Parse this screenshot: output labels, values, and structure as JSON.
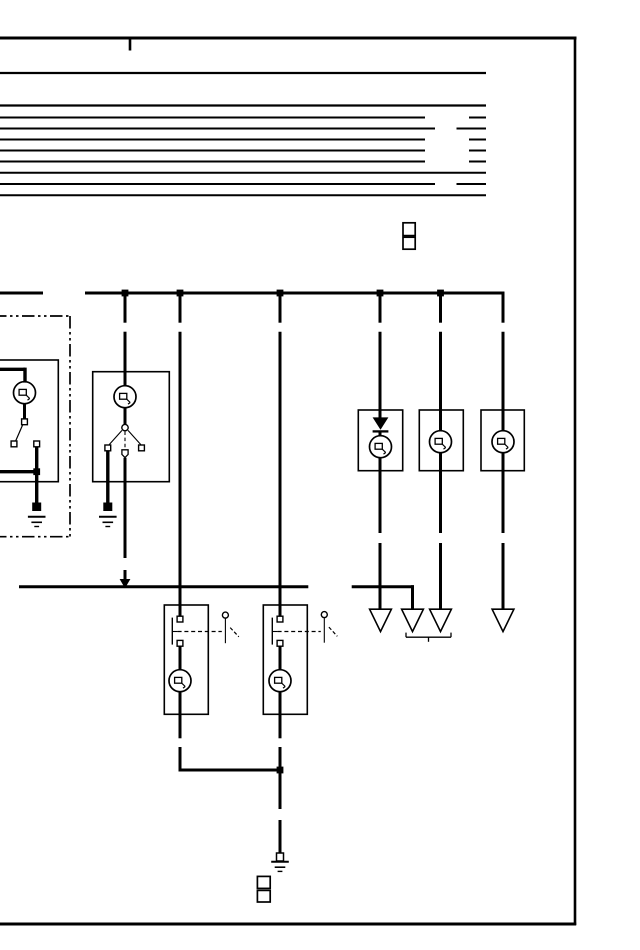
{
  "meta": {
    "width": 640,
    "height": 950,
    "bg": "#ffffff",
    "ink": "#000000",
    "kind": "automotive-wiring-diagram-scan",
    "symbols": {
      "bulb": "lamp-symbol",
      "gnd": "ground-symbol",
      "dot": "wire-junction",
      "poly": "filled-shape",
      "term": "connector-terminal",
      "pent": "connector-terminal-pointed",
      "tofu": "unrendered-text-glyph-box"
    }
  },
  "elements": [
    {
      "t": "line",
      "n": "frame-top-border",
      "x1": 0,
      "y1": 38,
      "x2": 576.5,
      "y2": 38,
      "w": 3
    },
    {
      "t": "line",
      "n": "frame-right-border",
      "x1": 575,
      "y1": 37,
      "x2": 575,
      "y2": 925,
      "w": 2.6
    },
    {
      "t": "line",
      "n": "frame-bottom-border",
      "x1": 0,
      "y1": 924,
      "x2": 576.2,
      "y2": 924,
      "w": 3
    },
    {
      "t": "line",
      "n": "frame-top-tick",
      "x1": 130,
      "y1": 39,
      "x2": 130,
      "y2": 50.5,
      "w": 2.6
    },
    {
      "t": "line",
      "n": "header-rule",
      "x1": 0,
      "y1": 73,
      "x2": 486,
      "y2": 73,
      "w": 2.3
    },
    {
      "t": "line",
      "n": "header-rule",
      "x1": 0,
      "y1": 105.5,
      "x2": 486,
      "y2": 105.5,
      "w": 2.3
    },
    {
      "t": "line",
      "n": "header-rule",
      "x1": 0,
      "y1": 117.5,
      "x2": 425,
      "y2": 117.5,
      "w": 2
    },
    {
      "t": "line",
      "n": "header-rule-stub",
      "x1": 469,
      "y1": 117.5,
      "x2": 486,
      "y2": 117.5,
      "w": 2
    },
    {
      "t": "line",
      "n": "header-rule",
      "x1": 0,
      "y1": 128.5,
      "x2": 435,
      "y2": 128.5,
      "w": 2
    },
    {
      "t": "line",
      "n": "header-rule-stub",
      "x1": 456.5,
      "y1": 128.5,
      "x2": 486,
      "y2": 128.5,
      "w": 2
    },
    {
      "t": "line",
      "n": "header-rule",
      "x1": 0,
      "y1": 139.5,
      "x2": 425,
      "y2": 139.5,
      "w": 2
    },
    {
      "t": "line",
      "n": "header-rule-stub",
      "x1": 469,
      "y1": 139.5,
      "x2": 486,
      "y2": 139.5,
      "w": 2
    },
    {
      "t": "line",
      "n": "header-rule",
      "x1": 0,
      "y1": 150.5,
      "x2": 425,
      "y2": 150.5,
      "w": 2
    },
    {
      "t": "line",
      "n": "header-rule-stub",
      "x1": 469,
      "y1": 150.5,
      "x2": 486,
      "y2": 150.5,
      "w": 2
    },
    {
      "t": "line",
      "n": "header-rule",
      "x1": 0,
      "y1": 161.5,
      "x2": 425,
      "y2": 161.5,
      "w": 2
    },
    {
      "t": "line",
      "n": "header-rule-stub",
      "x1": 469,
      "y1": 161.5,
      "x2": 486,
      "y2": 161.5,
      "w": 2
    },
    {
      "t": "line",
      "n": "header-rule",
      "x1": 0,
      "y1": 172.8,
      "x2": 486,
      "y2": 172.8,
      "w": 2
    },
    {
      "t": "line",
      "n": "header-rule",
      "x1": 0,
      "y1": 184,
      "x2": 435,
      "y2": 184,
      "w": 2
    },
    {
      "t": "line",
      "n": "header-rule-stub",
      "x1": 456.5,
      "y1": 184,
      "x2": 486,
      "y2": 184,
      "w": 2
    },
    {
      "t": "line",
      "n": "header-rule",
      "x1": 0,
      "y1": 195.2,
      "x2": 486,
      "y2": 195.2,
      "w": 2
    },
    {
      "t": "tofu",
      "n": "unrendered-label-box",
      "x": 403,
      "y": 222.8,
      "w": 12.2,
      "h": 12.8
    },
    {
      "t": "tofu",
      "n": "unrendered-label-box",
      "x": 403,
      "y": 237.2,
      "w": 12.2,
      "h": 12
    },
    {
      "t": "line",
      "n": "harness-enclosure-dashdot",
      "x1": -6,
      "y1": 316,
      "x2": 70,
      "y2": 316,
      "w": 1.7,
      "dash": "12.5 3.5 2.5 3.5 2.5 3.5"
    },
    {
      "t": "line",
      "n": "harness-enclosure-dashdot",
      "x1": 70,
      "y1": 316,
      "x2": 70,
      "y2": 536.7,
      "w": 1.7,
      "dash": "12.5 3.5 2.5 3.5 2.5 3.5"
    },
    {
      "t": "line",
      "n": "harness-enclosure-dashdot",
      "x1": -6,
      "y1": 536.7,
      "x2": 70,
      "y2": 536.7,
      "w": 1.7,
      "dash": "12.5 3.5 2.5 3.5 2.5 3.5"
    },
    {
      "t": "rect",
      "n": "component-box-lamp-switch-1",
      "x": -12,
      "y": 360,
      "w": 70.3,
      "h": 121.7
    },
    {
      "t": "rect",
      "n": "component-box-lamp-switch-2",
      "x": 92.7,
      "y": 371.7,
      "w": 76.6,
      "h": 110
    },
    {
      "t": "rect",
      "n": "component-box-switch-lamp-A",
      "x": 164.3,
      "y": 605,
      "w": 44,
      "h": 109.3
    },
    {
      "t": "rect",
      "n": "component-box-switch-lamp-B",
      "x": 263.3,
      "y": 605,
      "w": 44,
      "h": 109.3
    },
    {
      "t": "rect",
      "n": "component-box-diode-lamp",
      "x": 358.3,
      "y": 410,
      "w": 44.4,
      "h": 60.7
    },
    {
      "t": "rect",
      "n": "component-box-lamp-R2",
      "x": 419.3,
      "y": 410,
      "w": 44,
      "h": 60.7
    },
    {
      "t": "rect",
      "n": "component-box-lamp-R3",
      "x": 481,
      "y": 410,
      "w": 43.3,
      "h": 60.7
    },
    {
      "t": "line",
      "n": "bus-wire",
      "x1": 0,
      "y1": 293,
      "x2": 43,
      "y2": 293,
      "w": 3
    },
    {
      "t": "line",
      "n": "bus-wire",
      "x1": 85,
      "y1": 293,
      "x2": 504.3,
      "y2": 293,
      "w": 3
    },
    {
      "t": "line",
      "n": "wire-drop",
      "x1": 503,
      "y1": 291.6,
      "x2": 503,
      "y2": 322.7,
      "w": 3
    },
    {
      "t": "line",
      "n": "wire-drop",
      "x1": 125,
      "y1": 293,
      "x2": 125,
      "y2": 322.7,
      "w": 3
    },
    {
      "t": "line",
      "n": "wire-drop",
      "x1": 125,
      "y1": 331.7,
      "x2": 125,
      "y2": 386.5,
      "w": 3
    },
    {
      "t": "line",
      "n": "wire-drop",
      "x1": 180,
      "y1": 293,
      "x2": 180,
      "y2": 322.7,
      "w": 3
    },
    {
      "t": "line",
      "n": "wire-drop",
      "x1": 180,
      "y1": 331.7,
      "x2": 180,
      "y2": 616.3,
      "w": 3
    },
    {
      "t": "line",
      "n": "wire-drop",
      "x1": 280,
      "y1": 293,
      "x2": 280,
      "y2": 322.7,
      "w": 3
    },
    {
      "t": "line",
      "n": "wire-drop",
      "x1": 280,
      "y1": 331.7,
      "x2": 280,
      "y2": 616.3,
      "w": 3
    },
    {
      "t": "line",
      "n": "wire-drop",
      "x1": 380,
      "y1": 293,
      "x2": 380,
      "y2": 322.7,
      "w": 3
    },
    {
      "t": "line",
      "n": "wire-drop",
      "x1": 380,
      "y1": 331.7,
      "x2": 380,
      "y2": 418.3,
      "w": 3
    },
    {
      "t": "line",
      "n": "wire-drop",
      "x1": 440.5,
      "y1": 293,
      "x2": 440.5,
      "y2": 322.7,
      "w": 3
    },
    {
      "t": "line",
      "n": "wire-drop",
      "x1": 440.5,
      "y1": 331.7,
      "x2": 440.5,
      "y2": 431.3,
      "w": 3
    },
    {
      "t": "line",
      "n": "wire-drop",
      "x1": 503,
      "y1": 331.7,
      "x2": 503,
      "y2": 431.3,
      "w": 3
    },
    {
      "t": "line",
      "n": "wire",
      "x1": 0,
      "y1": 369.3,
      "x2": 25,
      "y2": 369.3,
      "w": 3.4
    },
    {
      "t": "line",
      "n": "wire",
      "x1": 25,
      "y1": 367.6,
      "x2": 25,
      "y2": 382.6,
      "w": 3.4
    },
    {
      "t": "line",
      "n": "wire",
      "x1": 24.5,
      "y1": 403.2,
      "x2": 24.5,
      "y2": 419,
      "w": 3
    },
    {
      "t": "line",
      "n": "switch-lever",
      "x1": 22.6,
      "y1": 425,
      "x2": 15.8,
      "y2": 440.6,
      "w": 1.2
    },
    {
      "t": "line",
      "n": "wire",
      "x1": 36.7,
      "y1": 446.6,
      "x2": 36.7,
      "y2": 503.5,
      "w": 3.4
    },
    {
      "t": "line",
      "n": "wire",
      "x1": 0,
      "y1": 471.7,
      "x2": 36.7,
      "y2": 471.7,
      "w": 3.4
    },
    {
      "t": "line",
      "n": "wire",
      "x1": 125,
      "y1": 407.2,
      "x2": 125,
      "y2": 424.3,
      "w": 3
    },
    {
      "t": "line",
      "n": "switch-lever",
      "x1": 122,
      "y1": 430.4,
      "x2": 109.2,
      "y2": 444.6,
      "w": 1.1
    },
    {
      "t": "line",
      "n": "switch-lever",
      "x1": 128,
      "y1": 430.4,
      "x2": 140.8,
      "y2": 444.6,
      "w": 1.1
    },
    {
      "t": "line",
      "n": "switch-link-dashed",
      "x1": 125,
      "y1": 431.5,
      "x2": 125,
      "y2": 448.2,
      "w": 1.1,
      "dash": "3.5 2.6"
    },
    {
      "t": "line",
      "n": "wire",
      "x1": 107.8,
      "y1": 450.6,
      "x2": 107.8,
      "y2": 503.5,
      "w": 3.4
    },
    {
      "t": "line",
      "n": "wire",
      "x1": 125,
      "y1": 457.8,
      "x2": 125,
      "y2": 558,
      "w": 3
    },
    {
      "t": "line",
      "n": "wire",
      "x1": 125,
      "y1": 570,
      "x2": 125,
      "y2": 580.2,
      "w": 3
    },
    {
      "t": "line",
      "n": "feed-bus-wire",
      "x1": 19,
      "y1": 586.7,
      "x2": 308.3,
      "y2": 586.7,
      "w": 3
    },
    {
      "t": "line",
      "n": "feed-bus-wire",
      "x1": 351.7,
      "y1": 586.7,
      "x2": 414,
      "y2": 586.7,
      "w": 3
    },
    {
      "t": "line",
      "n": "wire-drop",
      "x1": 412.5,
      "y1": 585.2,
      "x2": 412.5,
      "y2": 609.8,
      "w": 3
    },
    {
      "t": "line",
      "n": "switch-plate",
      "x1": 172.3,
      "y1": 617.6,
      "x2": 172.3,
      "y2": 644.6,
      "w": 1.4
    },
    {
      "t": "line",
      "n": "switch-plate-tick",
      "x1": 172.9,
      "y1": 631.5,
      "x2": 177.6,
      "y2": 631.5,
      "w": 1.1
    },
    {
      "t": "line",
      "n": "switch-link-dashed",
      "x1": 177.6,
      "y1": 631.5,
      "x2": 221.8,
      "y2": 631.5,
      "w": 1.2,
      "dash": "4 2.8"
    },
    {
      "t": "line",
      "n": "switch-lever",
      "x1": 225.4,
      "y1": 618.4,
      "x2": 225.4,
      "y2": 643.2,
      "w": 1.1
    },
    {
      "t": "line",
      "n": "switch-lever-dashed",
      "x1": 230.2,
      "y1": 627.6,
      "x2": 238.8,
      "y2": 636.8,
      "w": 1.2,
      "dash": "3.6 2.2"
    },
    {
      "t": "line",
      "n": "wire",
      "x1": 180,
      "y1": 645.9,
      "x2": 180,
      "y2": 670.2,
      "w": 3
    },
    {
      "t": "line",
      "n": "wire",
      "x1": 180,
      "y1": 691.2,
      "x2": 180,
      "y2": 714.3,
      "w": 3
    },
    {
      "t": "line",
      "n": "switch-plate",
      "x1": 272.3,
      "y1": 617.6,
      "x2": 272.3,
      "y2": 644.6,
      "w": 1.4
    },
    {
      "t": "line",
      "n": "switch-plate-tick",
      "x1": 272.9,
      "y1": 631.5,
      "x2": 277.6,
      "y2": 631.5,
      "w": 1.1
    },
    {
      "t": "line",
      "n": "switch-link-dashed",
      "x1": 277.6,
      "y1": 631.5,
      "x2": 320.8,
      "y2": 631.5,
      "w": 1.2,
      "dash": "4 2.8"
    },
    {
      "t": "line",
      "n": "switch-lever",
      "x1": 324.3,
      "y1": 617.9,
      "x2": 324.3,
      "y2": 642.7,
      "w": 1.1
    },
    {
      "t": "line",
      "n": "switch-lever-dashed",
      "x1": 328.9,
      "y1": 627.1,
      "x2": 337.3,
      "y2": 636.3,
      "w": 1.2,
      "dash": "3.6 2.2"
    },
    {
      "t": "line",
      "n": "wire",
      "x1": 280,
      "y1": 645.9,
      "x2": 280,
      "y2": 670.2,
      "w": 3
    },
    {
      "t": "line",
      "n": "wire",
      "x1": 280,
      "y1": 691.2,
      "x2": 280,
      "y2": 714.3,
      "w": 3
    },
    {
      "t": "line",
      "n": "wire",
      "x1": 180,
      "y1": 714.3,
      "x2": 180,
      "y2": 738.3,
      "w": 3
    },
    {
      "t": "line",
      "n": "wire",
      "x1": 180,
      "y1": 747,
      "x2": 180,
      "y2": 771.5,
      "w": 3
    },
    {
      "t": "line",
      "n": "wire",
      "x1": 178.5,
      "y1": 770,
      "x2": 280,
      "y2": 770,
      "w": 3
    },
    {
      "t": "line",
      "n": "wire",
      "x1": 280,
      "y1": 714.3,
      "x2": 280,
      "y2": 738.3,
      "w": 3
    },
    {
      "t": "line",
      "n": "wire",
      "x1": 280,
      "y1": 747,
      "x2": 280,
      "y2": 809,
      "w": 3
    },
    {
      "t": "line",
      "n": "wire",
      "x1": 280,
      "y1": 820,
      "x2": 280,
      "y2": 853.8,
      "w": 3
    },
    {
      "t": "line",
      "n": "diode-cathode-bar",
      "x1": 372.6,
      "y1": 431.4,
      "x2": 388.4,
      "y2": 431.4,
      "w": 2.3
    },
    {
      "t": "line",
      "n": "wire",
      "x1": 380,
      "y1": 431.4,
      "x2": 380,
      "y2": 436.2,
      "w": 3
    },
    {
      "t": "line",
      "n": "wire",
      "x1": 380,
      "y1": 457.3,
      "x2": 380,
      "y2": 533,
      "w": 3
    },
    {
      "t": "line",
      "n": "wire",
      "x1": 380,
      "y1": 543,
      "x2": 380,
      "y2": 609.8,
      "w": 3
    },
    {
      "t": "line",
      "n": "wire",
      "x1": 440.5,
      "y1": 452.3,
      "x2": 440.5,
      "y2": 533,
      "w": 3
    },
    {
      "t": "line",
      "n": "wire",
      "x1": 440.5,
      "y1": 543,
      "x2": 440.5,
      "y2": 609.8,
      "w": 3
    },
    {
      "t": "line",
      "n": "wire",
      "x1": 503,
      "y1": 452.3,
      "x2": 503,
      "y2": 533,
      "w": 3
    },
    {
      "t": "line",
      "n": "wire",
      "x1": 503,
      "y1": 543,
      "x2": 503,
      "y2": 609.8,
      "w": 3
    },
    {
      "t": "poly",
      "n": "diode-symbol",
      "p": "372.6,417.4 388.4,417.4 380.5,429.8",
      "f": "ink"
    },
    {
      "t": "poly",
      "n": "arrow-junction",
      "p": "119.6,579 130.4,579 125,588.2",
      "f": "ink"
    },
    {
      "t": "poly",
      "n": "connector-arrow",
      "p": "369.6,609.2 391.4,609.2 380.5,631.6",
      "f": "none"
    },
    {
      "t": "poly",
      "n": "connector-arrow",
      "p": "401.6,609.2 423.4,609.2 412.5,631.6",
      "f": "none"
    },
    {
      "t": "poly",
      "n": "connector-arrow",
      "p": "429.6,609.2 451.4,609.2 440.5,631.6",
      "f": "none"
    },
    {
      "t": "poly",
      "n": "connector-arrow",
      "p": "492.1,609.2 513.9,609.2 503,631.6",
      "f": "none"
    },
    {
      "t": "line",
      "n": "group-bracket",
      "x1": 406,
      "y1": 637.2,
      "x2": 451,
      "y2": 637.2,
      "w": 1.3
    },
    {
      "t": "line",
      "n": "group-bracket",
      "x1": 406,
      "y1": 632.6,
      "x2": 406,
      "y2": 637.2,
      "w": 1.3
    },
    {
      "t": "line",
      "n": "group-bracket",
      "x1": 451,
      "y1": 632.6,
      "x2": 451,
      "y2": 637.2,
      "w": 1.3
    },
    {
      "t": "line",
      "n": "group-bracket",
      "x1": 428.5,
      "y1": 637.2,
      "x2": 428.5,
      "y2": 641.8,
      "w": 1.3
    },
    {
      "t": "dot",
      "n": "wire-junction",
      "x": 125,
      "y": 293
    },
    {
      "t": "dot",
      "n": "wire-junction",
      "x": 180,
      "y": 293
    },
    {
      "t": "dot",
      "n": "wire-junction",
      "x": 280,
      "y": 293
    },
    {
      "t": "dot",
      "n": "wire-junction",
      "x": 380,
      "y": 293
    },
    {
      "t": "dot",
      "n": "wire-junction",
      "x": 440.5,
      "y": 293
    },
    {
      "t": "dot",
      "n": "wire-junction",
      "x": 36.7,
      "y": 471.7
    },
    {
      "t": "dot",
      "n": "wire-junction",
      "x": 280,
      "y": 770
    },
    {
      "t": "gnd",
      "n": "ground-symbol",
      "x": 36.7,
      "y": 502.5,
      "v": "filled"
    },
    {
      "t": "gnd",
      "n": "ground-symbol",
      "x": 107.8,
      "y": 502.5,
      "v": "filled"
    },
    {
      "t": "gnd",
      "n": "ground-symbol",
      "x": 280,
      "y": 853,
      "v": "open"
    },
    {
      "t": "bulb",
      "n": "lamp-symbol",
      "cx": 24.5,
      "cy": 392.7
    },
    {
      "t": "bulb",
      "n": "lamp-symbol",
      "cx": 125,
      "cy": 396.7
    },
    {
      "t": "bulb",
      "n": "lamp-symbol",
      "cx": 180,
      "cy": 680.7
    },
    {
      "t": "bulb",
      "n": "lamp-symbol",
      "cx": 280,
      "cy": 680.7
    },
    {
      "t": "bulb",
      "n": "lamp-symbol",
      "cx": 380.5,
      "cy": 446.7
    },
    {
      "t": "bulb",
      "n": "lamp-symbol",
      "cx": 440.5,
      "cy": 441.7
    },
    {
      "t": "bulb",
      "n": "lamp-symbol",
      "cx": 503,
      "cy": 441.7
    },
    {
      "t": "term",
      "n": "connector-terminal",
      "x": 24.5,
      "y": 421.8
    },
    {
      "t": "term",
      "n": "connector-terminal",
      "x": 14,
      "y": 443.9
    },
    {
      "t": "term",
      "n": "connector-terminal",
      "x": 36.7,
      "y": 443.9
    },
    {
      "t": "circ",
      "n": "switch-pivot",
      "cx": 125,
      "cy": 427.6,
      "r": 3.2
    },
    {
      "t": "term",
      "n": "connector-terminal",
      "x": 107.8,
      "y": 447.9
    },
    {
      "t": "term",
      "n": "connector-terminal",
      "x": 141.5,
      "y": 447.9
    },
    {
      "t": "pent",
      "n": "connector-terminal-pointed",
      "x": 125,
      "y": 449.8
    },
    {
      "t": "term",
      "n": "connector-terminal",
      "x": 180,
      "y": 619.1
    },
    {
      "t": "term",
      "n": "connector-terminal",
      "x": 180,
      "y": 643.3
    },
    {
      "t": "circ",
      "n": "switch-contact",
      "cx": 225.4,
      "cy": 615.1,
      "r": 3
    },
    {
      "t": "term",
      "n": "connector-terminal",
      "x": 280,
      "y": 619.1
    },
    {
      "t": "term",
      "n": "connector-terminal",
      "x": 280,
      "y": 643.3
    },
    {
      "t": "circ",
      "n": "switch-contact",
      "cx": 324.3,
      "cy": 614.6,
      "r": 3
    },
    {
      "t": "tofu",
      "n": "unrendered-label-box",
      "x": 257.4,
      "y": 876.4,
      "w": 12.8,
      "h": 12
    },
    {
      "t": "tofu",
      "n": "unrendered-label-box",
      "x": 257.4,
      "y": 890.4,
      "w": 12.8,
      "h": 11.6
    }
  ]
}
